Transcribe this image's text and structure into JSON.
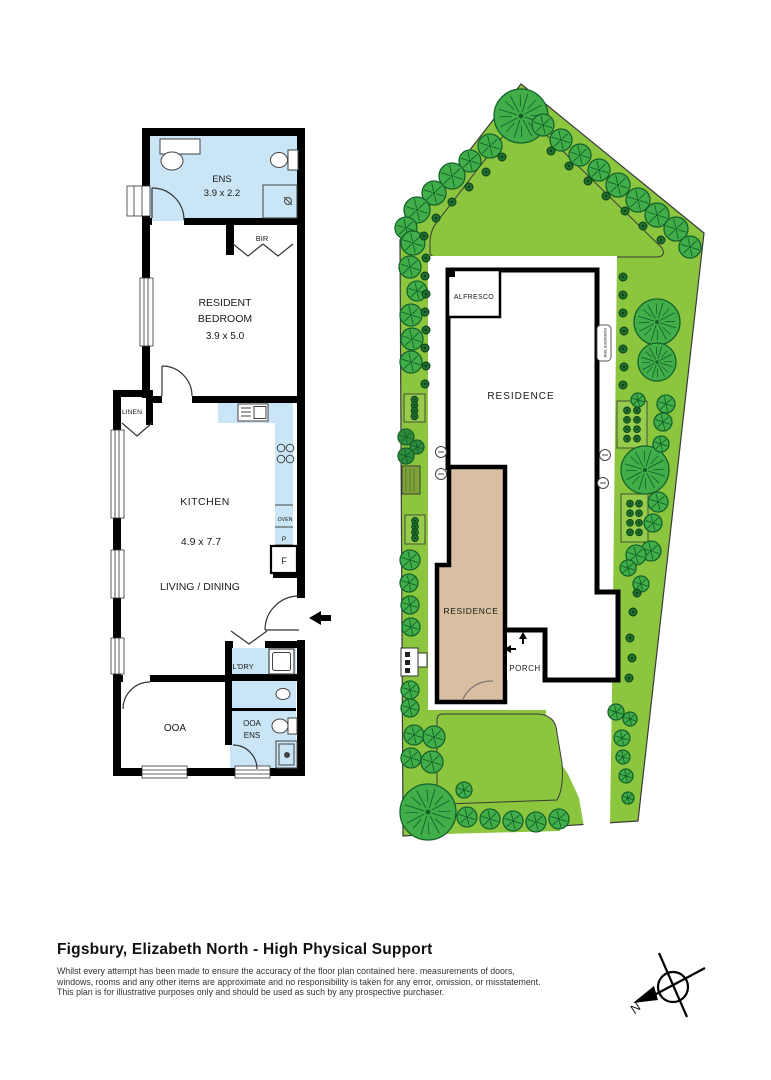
{
  "title_block": {
    "title": "Figsbury, Elizabeth North - High Physical Support",
    "disclaimer_line1": "Whilst every attempt has been made to ensure the accuracy of the floor plan contained here. measurements of doors,",
    "disclaimer_line2": "windows, rooms and any other items are approximate and no responsibility is taken for any error, omission, or misstatement.",
    "disclaimer_line3": "This plan is for illustrative purposes only and should be used as such by any prospective purchaser."
  },
  "floor_plan": {
    "ens": {
      "name": "ENS",
      "dims": "3.9 x 2.2"
    },
    "bir": {
      "name": "BIR"
    },
    "bedroom": {
      "line1": "RESIDENT",
      "line2": "BEDROOM",
      "dims": "3.9 x 5.0"
    },
    "linen": {
      "name": "LINEN"
    },
    "kitchen": {
      "name": "KITCHEN",
      "dims": "4.9 x 7.7"
    },
    "living": {
      "name": "LIVING / DINING"
    },
    "oven": "OVEN",
    "pantry": "P",
    "fridge": "F",
    "laundry": {
      "name": "L'DRY"
    },
    "ooa": {
      "name": "OOA"
    },
    "ooa_ens": {
      "line1": "OOA",
      "line2": "ENS"
    }
  },
  "site_plan": {
    "alfresco": "ALFRESCO",
    "residence_main": "RESIDENCE",
    "residence_second": "RESIDENCE",
    "porch": "PORCH",
    "tank": "RAINWATER TANK"
  },
  "compass": {
    "north": "N"
  },
  "colors": {
    "wall": "#000000",
    "wet_area": "#C9E5F6",
    "site_green": "#8CC63F",
    "tree_green": "#41AE49",
    "tree_outline": "#14622A",
    "shrub_green": "#1E7030",
    "residence_tan": "#D8BFA2",
    "paper": "#FFFFFF"
  }
}
